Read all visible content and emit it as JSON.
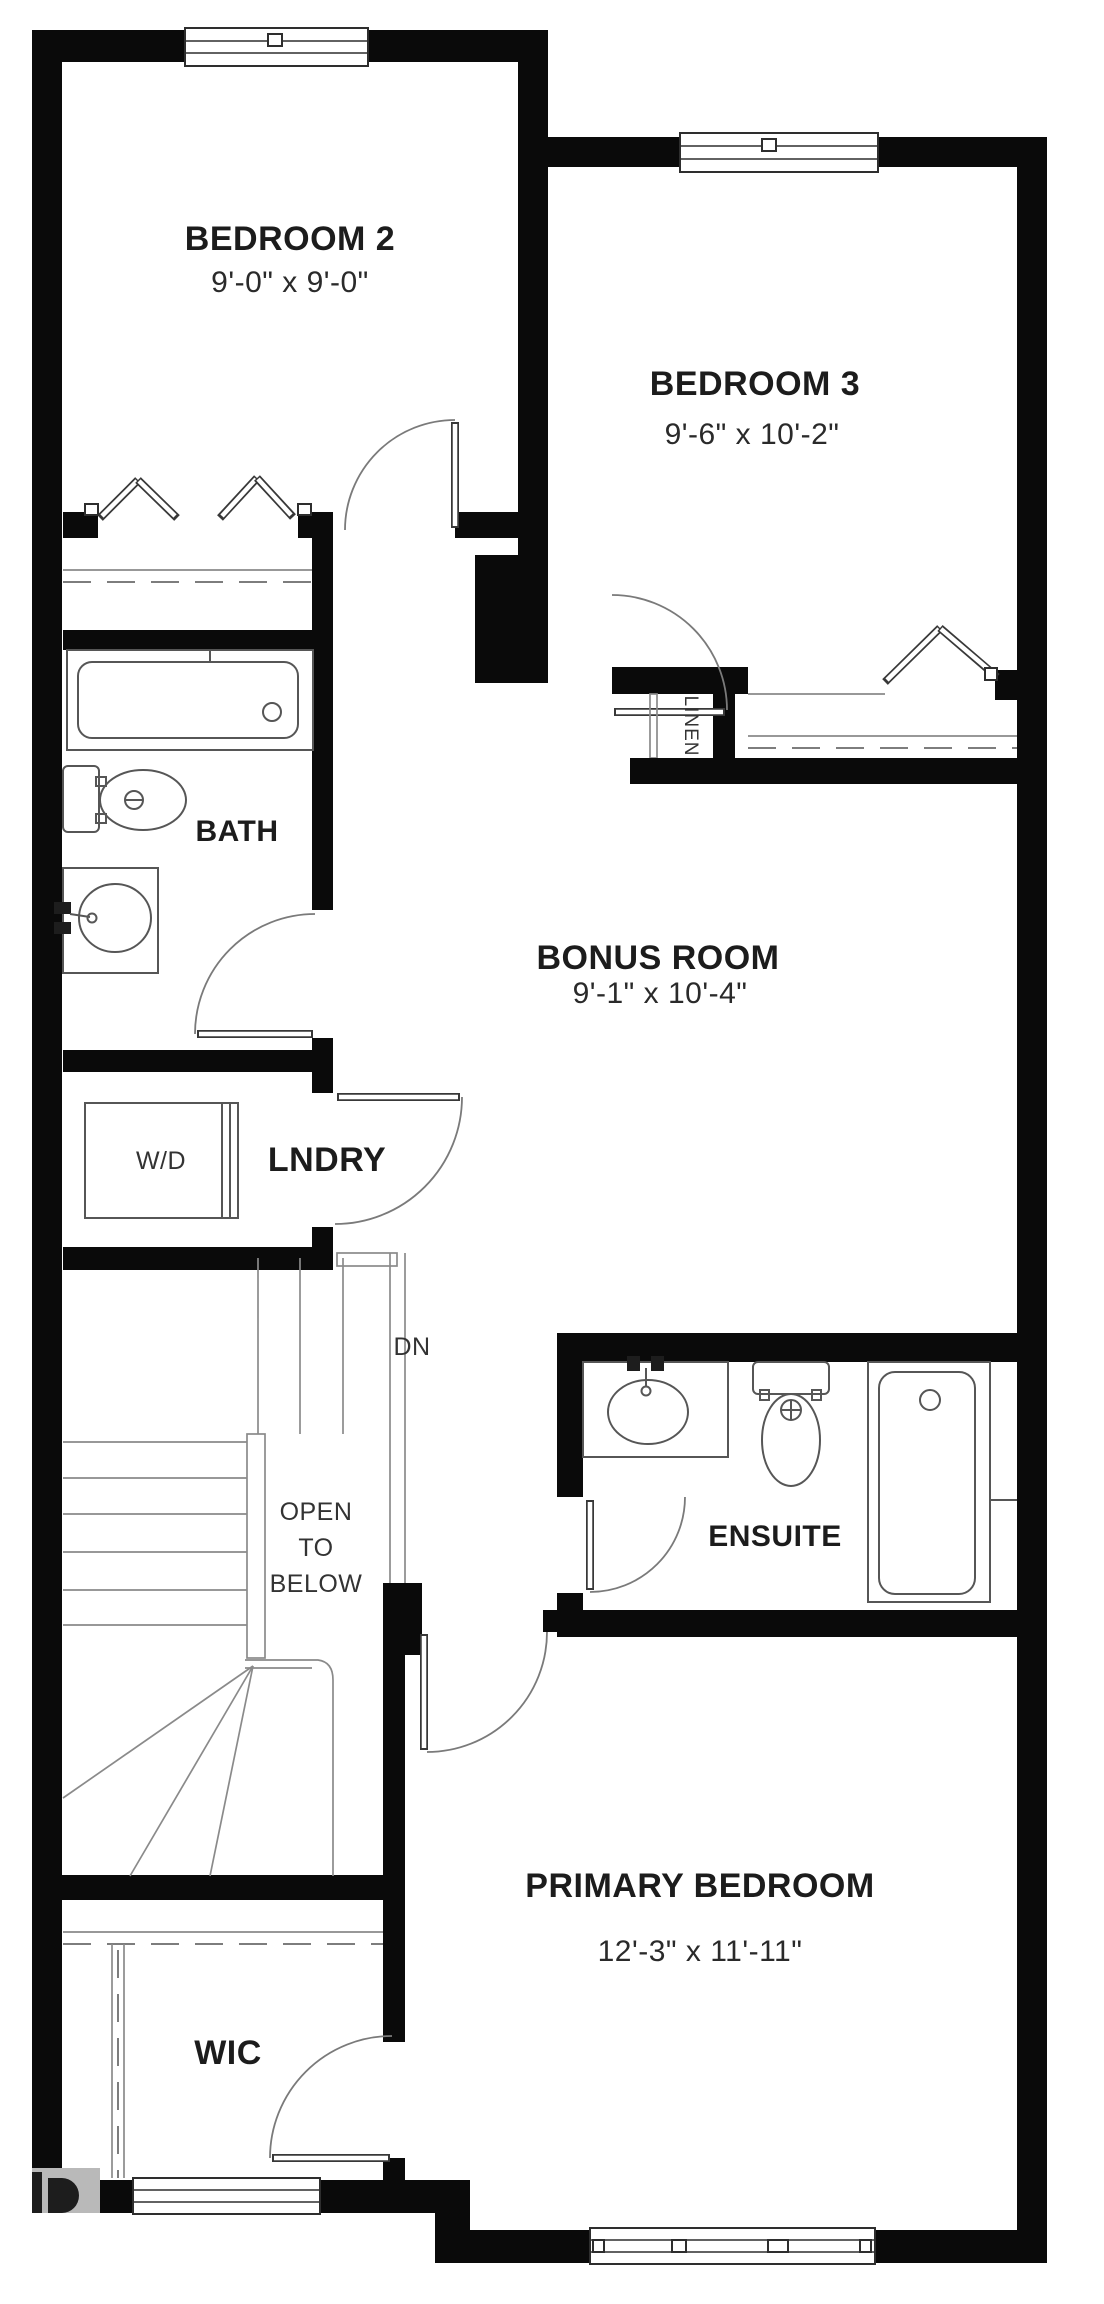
{
  "floorplan": {
    "bedroom2": {
      "name": "BEDROOM 2",
      "dims": "9'-0\" x 9'-0\""
    },
    "bedroom3": {
      "name": "BEDROOM 3",
      "dims": "9'-6\" x 10'-2\""
    },
    "bonus_room": {
      "name": "BONUS ROOM",
      "dims": "9'-1\" x 10'-4\""
    },
    "primary_bedroom": {
      "name": "PRIMARY BEDROOM",
      "dims": "12'-3\" x 11'-11\""
    },
    "bath": {
      "name": "BATH"
    },
    "ensuite": {
      "name": "ENSUITE"
    },
    "laundry": {
      "name": "LNDRY",
      "appliance": "W/D"
    },
    "linen": {
      "name": "LINEN"
    },
    "wic": {
      "name": "WIC"
    },
    "stairs": {
      "direction": "DN",
      "open_line1": "OPEN",
      "open_line2": "TO",
      "open_line3": "BELOW"
    },
    "colors": {
      "wall": "#0a0a0a",
      "fixture_line": "#565656",
      "text": "#1c1c1c"
    }
  }
}
